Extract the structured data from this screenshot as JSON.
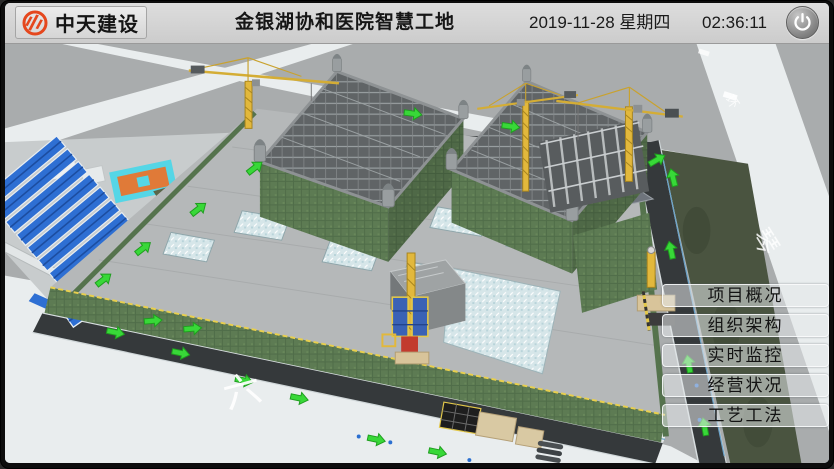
{
  "window": {
    "width": 834,
    "height": 469
  },
  "header": {
    "company": "中天建设",
    "title": "金银湖协和医院智慧工地",
    "date_line": "2019-11-28 星期四",
    "time": "02:36:11"
  },
  "menu": {
    "items": [
      {
        "id": "project-overview",
        "label": "项目概况"
      },
      {
        "id": "org-structure",
        "label": "组织架构"
      },
      {
        "id": "realtime-monitoring",
        "label": "实时监控"
      },
      {
        "id": "business-status",
        "label": "经营状况"
      },
      {
        "id": "craft-methods",
        "label": "工艺工法"
      }
    ]
  },
  "scene": {
    "description": "3D BIM view of hospital smart construction site",
    "road_markings": {
      "bottom_left": "六",
      "right_road_large": "琴",
      "right_road_small": "环"
    }
  },
  "theme": {
    "accent_red": "#e5471d",
    "header_bg": "#d6d6d6",
    "arrow_green": "#38d838",
    "roof_blue": "#2e6fd3",
    "mesh_green": "#5d7b53",
    "dark_road": "#35393b",
    "light_road": "#e9edee",
    "ground": "#a9acad",
    "crane_yellow": "#e2b83c",
    "court_cyan": "#55d6e6",
    "court_orange": "#e07a38",
    "strip_green": "#4a5440",
    "glass_blue": "#d6e6e9"
  }
}
